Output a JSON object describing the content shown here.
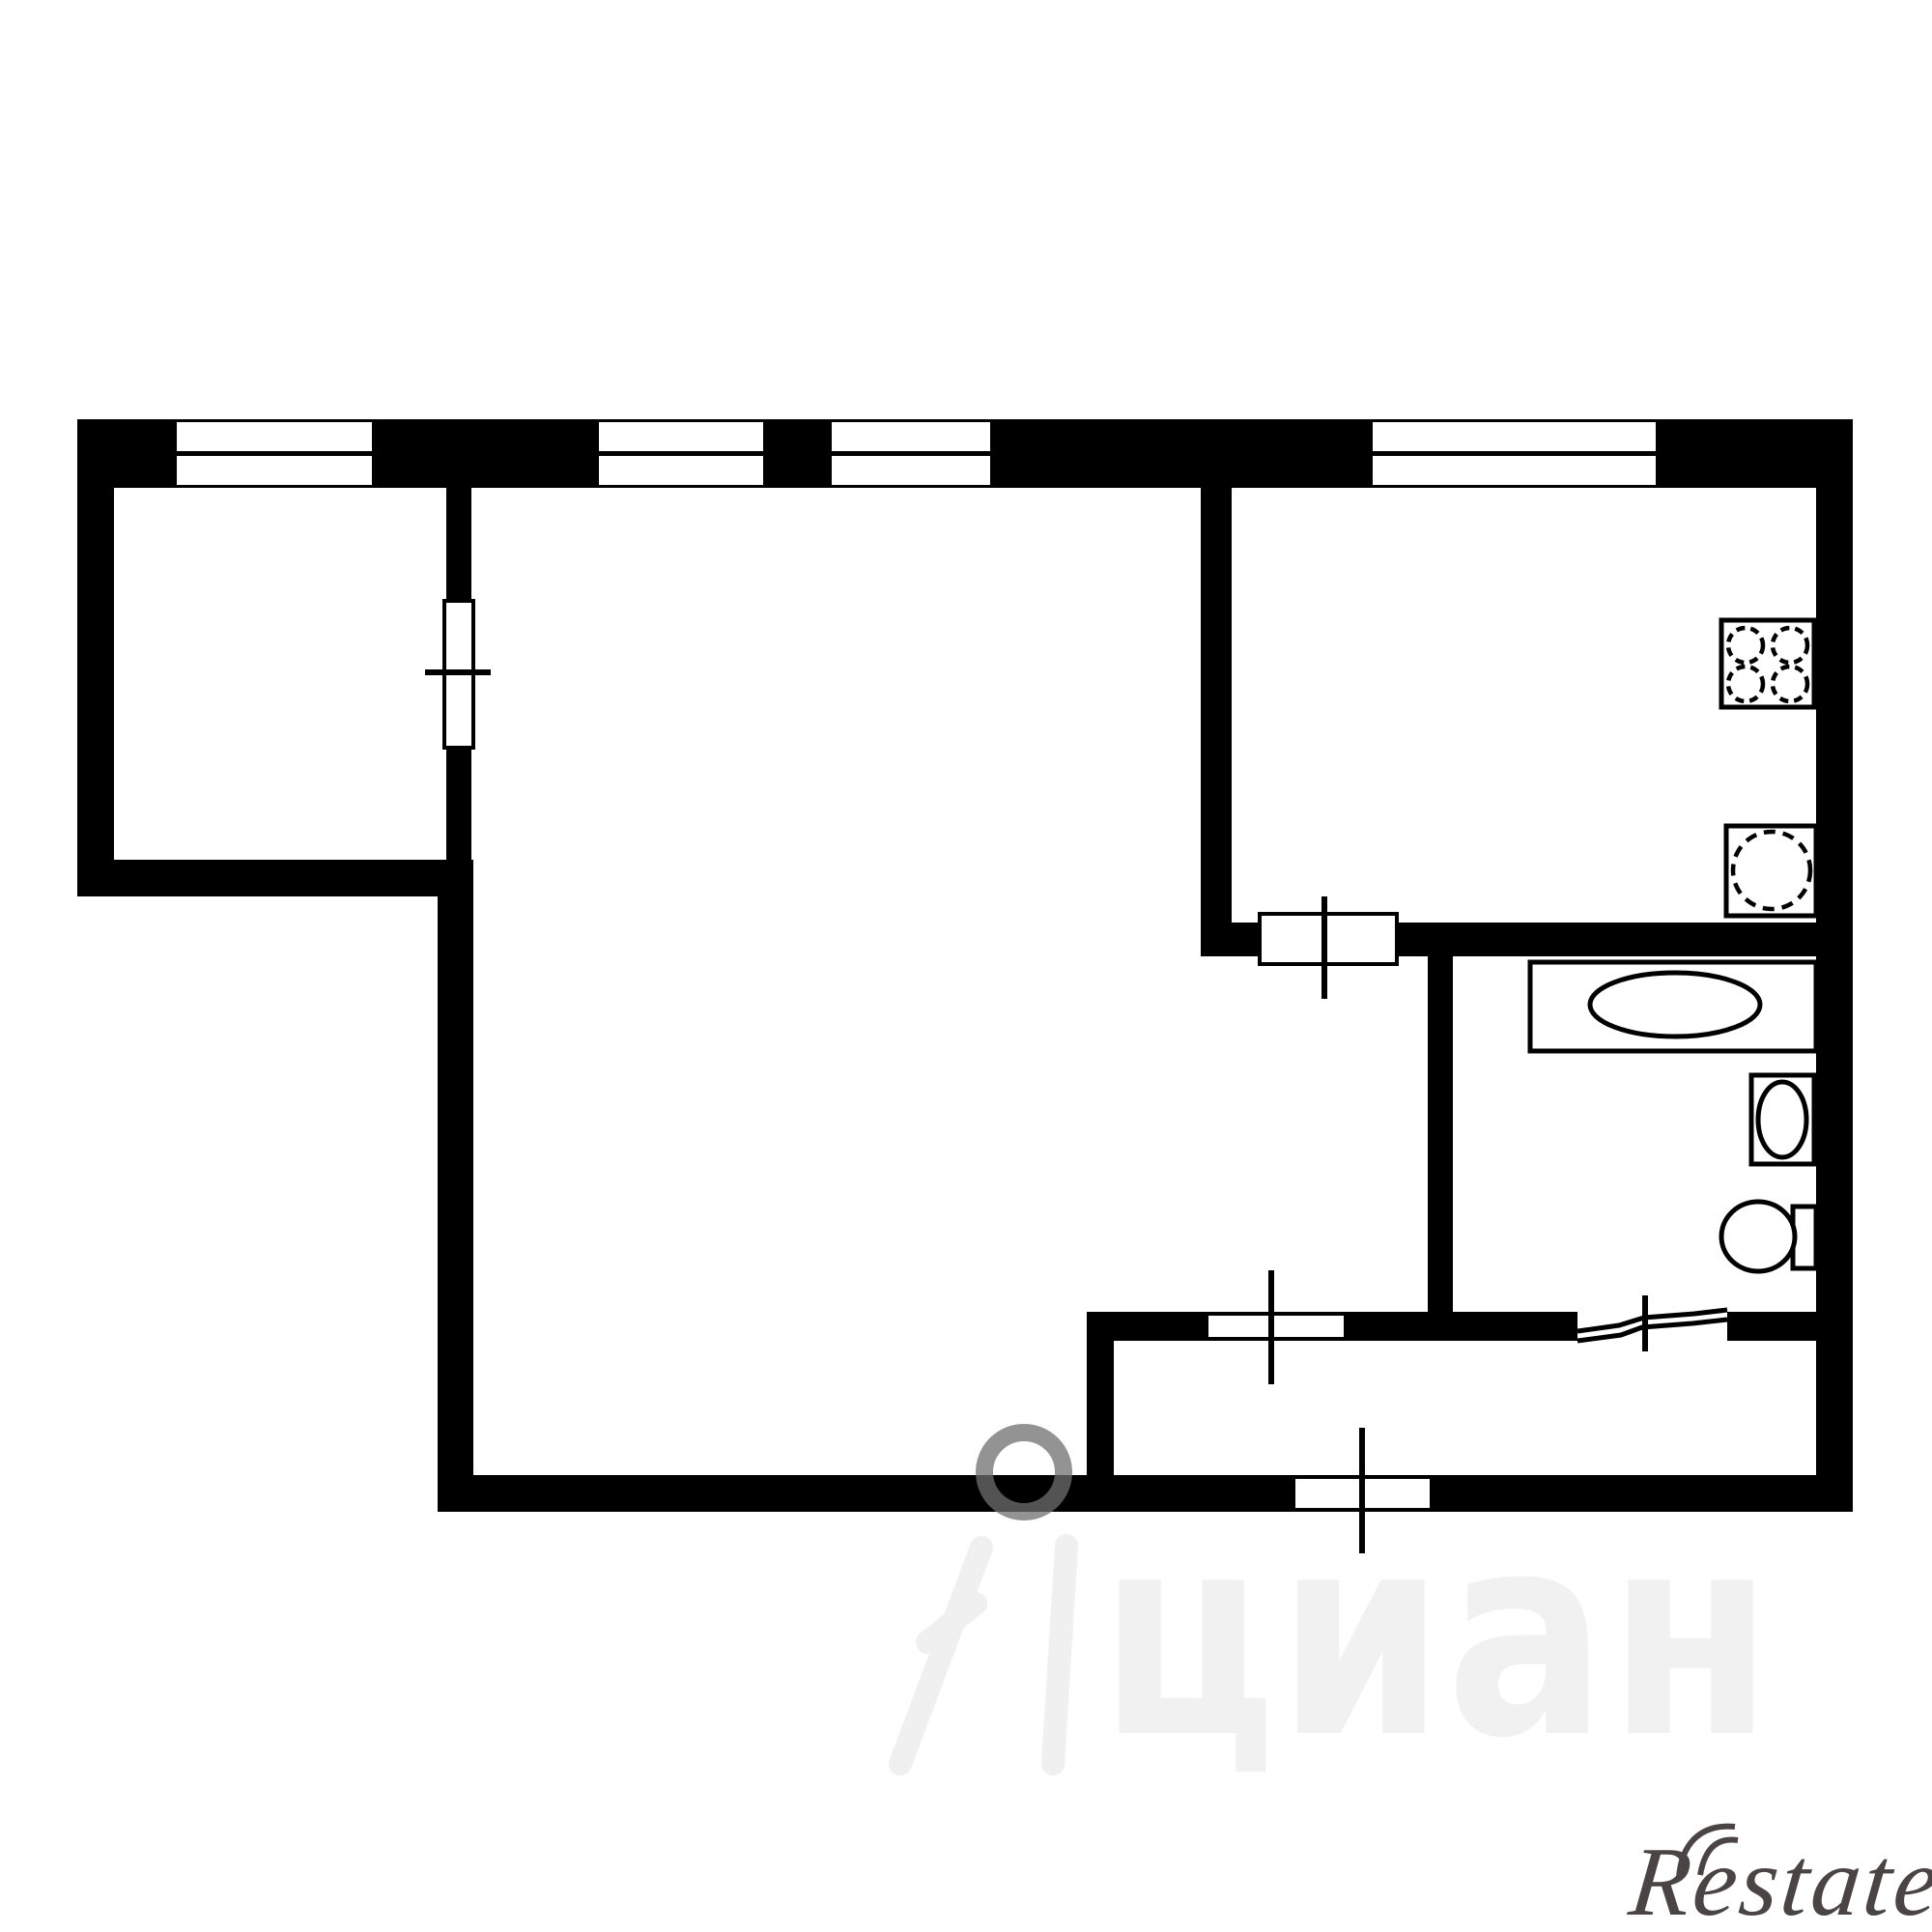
{
  "page": {
    "background_color": "#ffffff",
    "kind": "apartment floor plan drawing"
  },
  "plan": {
    "wall_color": "#000000",
    "fixture_outline_color": "#000000",
    "window_count": 4,
    "door_tick_count": 5,
    "fixtures": [
      {
        "name": "stove-icon",
        "shape": "square with 4 dashed burners"
      },
      {
        "name": "kitchen-sink-icon",
        "shape": "square with dashed circle"
      },
      {
        "name": "bathtub-icon",
        "shape": "rectangle with ellipse"
      },
      {
        "name": "washbasin-icon",
        "shape": "square with oval"
      },
      {
        "name": "toilet-icon",
        "shape": "bowl with cistern"
      }
    ]
  },
  "watermarks": {
    "cian": {
      "text": "циан",
      "text_color": "#f1f1f1",
      "ring_color": "#6f6f6f"
    },
    "restate": {
      "text": "Restate",
      "color": "#4b4444"
    }
  }
}
